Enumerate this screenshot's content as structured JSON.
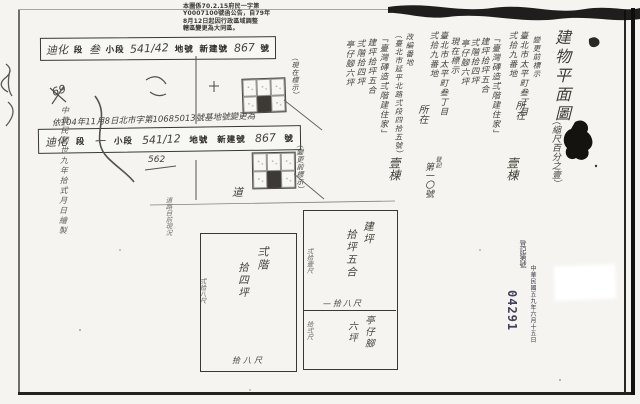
{
  "colors": {
    "paper": "#f5f4f0",
    "ink": "#3a3733",
    "stamp_serial": "#43405a"
  },
  "notice": {
    "l1": "本圖係70.2.15府民一字第",
    "l2": "Y0007100號函公告，自79年",
    "l3": "8月12日起因行政區域調整",
    "l4": "轄區變更為大同區。"
  },
  "lot_stamp_top": {
    "section": "迪化",
    "f1": "段",
    "subsection": "叁",
    "f2": "小段",
    "lot": "541/42",
    "f3": "地號",
    "f4": "新建號",
    "number": "867",
    "f5": "號"
  },
  "revision_note": "依104年11月8日北市字第10685013號基地號變更為",
  "lot_stamp_mid": {
    "section": "迪化",
    "f1": "段",
    "subsection": "一",
    "f2": "小段",
    "lot": "541/12",
    "f3": "地號",
    "f4": "新建號",
    "number": "867",
    "f5": "號",
    "sub_note": "562"
  },
  "margin_note": "中華民國世九年拾式月日繪製",
  "mark69": "69",
  "sketch": {
    "current_label": "（現在標示）",
    "before_label": "（變更前標示）",
    "road": "道",
    "road_note": "道路目前現況"
  },
  "title": {
    "main": "建物平面圖",
    "scale": "（縮尺百分之壹）"
  },
  "before": {
    "header": "變更前標示",
    "addr_line1": "臺北市太平町叁丁目",
    "addr_line2": "弍拾九番地",
    "location": "所在",
    "building": "「臺灣磚造弍階建住家」",
    "area_total": "建坪拾坪五合",
    "area_2f": "弍階拾四坪",
    "area_arcade": "亭仔腳六坪",
    "count": "壹棟"
  },
  "current": {
    "header": "現在標示",
    "addr_line1": "臺北市太平町叁丁目",
    "addr_line2": "弍拾九番地",
    "location": "所在",
    "renumber": "改編番地",
    "new_address": "（臺北市延平北路弍段四拾五號）",
    "building": "「臺灣磚造弍階建住家」",
    "area_total": "建坪拾坪五合",
    "area_2f": "弍階拾四坪",
    "area_arcade": "亭仔腳六坪",
    "count": "壹棟",
    "reg_small": "登記",
    "reg_no": "第一〇號"
  },
  "plan": {
    "floor2": {
      "name": "弍階",
      "area": "拾四坪",
      "side": "弍拾八尺",
      "width": "拾八尺"
    },
    "floor1": {
      "name": "建坪",
      "area": "拾坪五合",
      "side": "弍拾壹尺",
      "width": "—拾八尺"
    },
    "arcade": {
      "name": "亭仔腳",
      "area": "六坪",
      "side": "拾弍尺"
    }
  },
  "reg_stamp": {
    "head": "登記第號",
    "date": "中華民國五九年六月十五日",
    "serial": "04291"
  }
}
